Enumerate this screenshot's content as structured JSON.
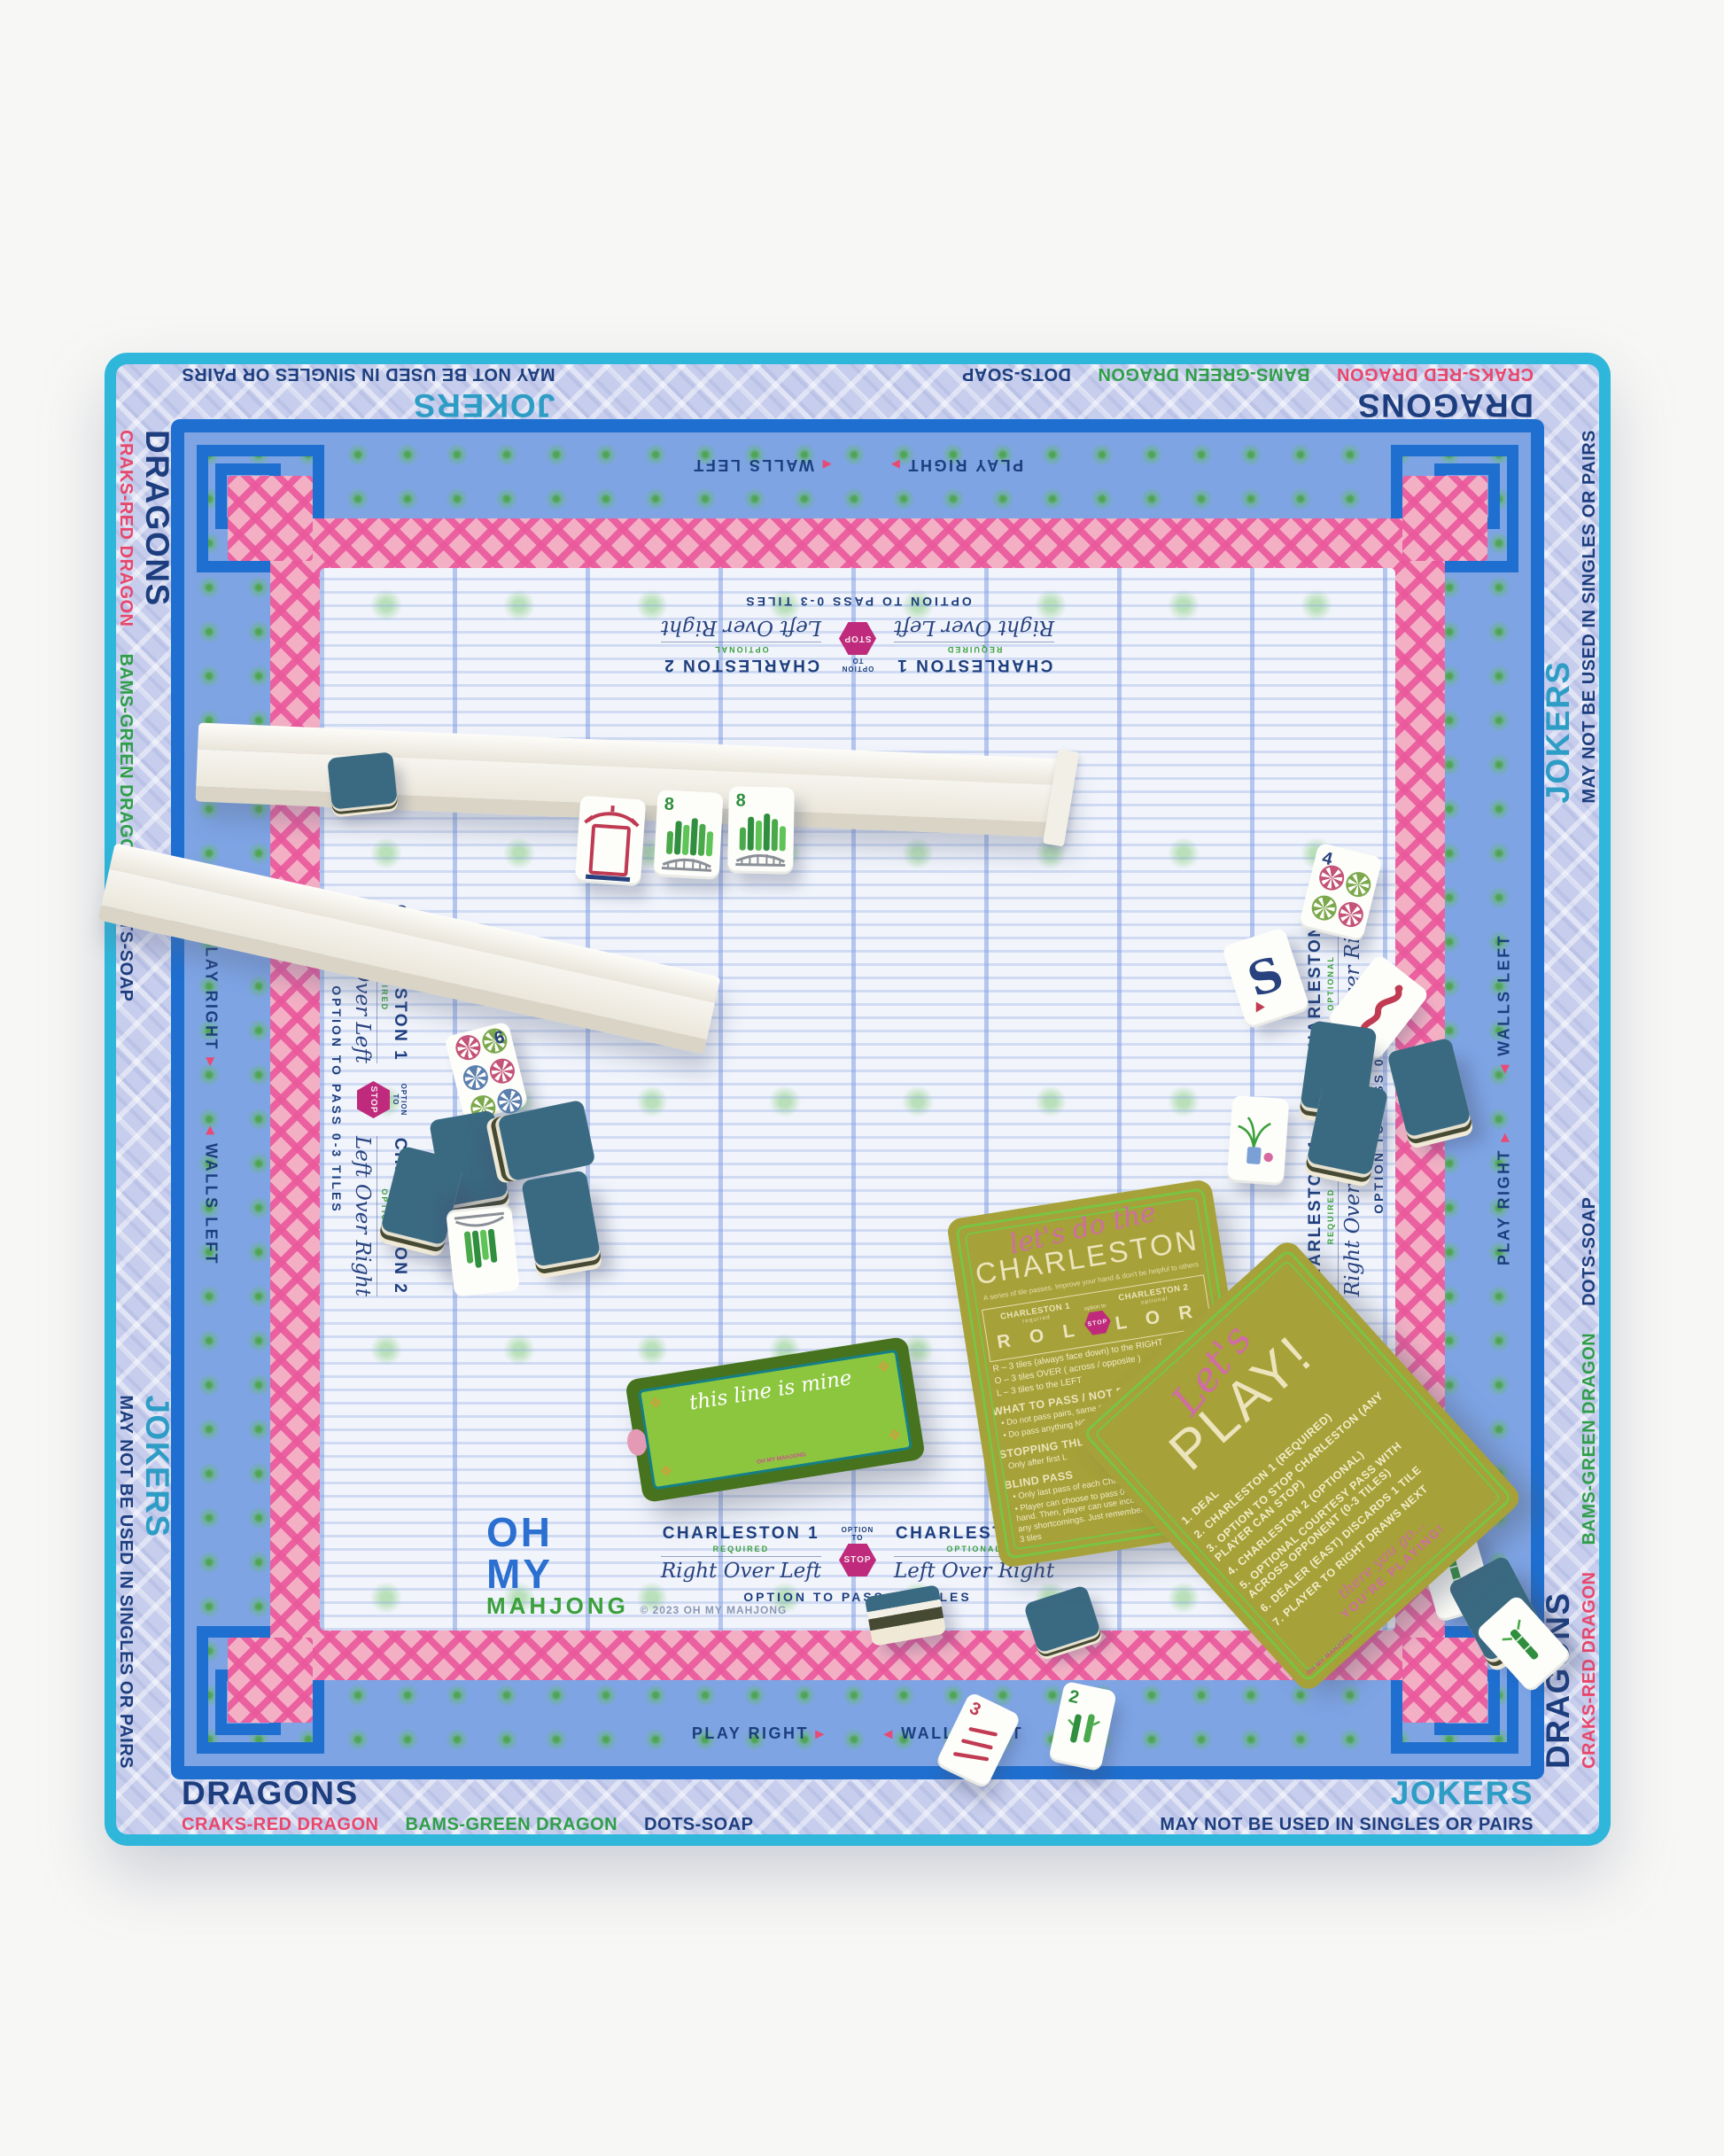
{
  "edge": {
    "dragons": "DRAGONS",
    "jokers": "JOKERS",
    "craks_note": "CRAKS-RED DRAGON",
    "bams_note": "BAMS-GREEN DRAGON",
    "dots_note": "DOTS-SOAP",
    "jokers_note": "MAY NOT BE USED IN SINGLES OR PAIRS"
  },
  "band": {
    "play_right": "PLAY RIGHT",
    "walls_left": "WALLS LEFT",
    "arrow_right": "▸",
    "arrow_left": "◂"
  },
  "charleston_block": {
    "c1_title": "CHARLESTON 1",
    "c1_sub": "REQUIRED",
    "c1_script": "Right Over Left",
    "option_to": "OPTION TO",
    "stop": "STOP",
    "c2_title": "CHARLESTON 2",
    "c2_sub": "OPTIONAL",
    "c2_script": "Left Over Right",
    "pass_note": "OPTION TO PASS 0-3 TILES"
  },
  "logo": {
    "line1": "OH",
    "line2": "MY",
    "line3": "MAHJONG",
    "copyright": "© 2023 OH MY MAHJONG"
  },
  "cards": {
    "charleston": {
      "script": "let's do the",
      "title": "CHARLESTON",
      "subtitle": "A series of tile passes. Improve your hand & don't be helpful to others",
      "box": {
        "c1": "CHARLESTON 1",
        "c1_sub": "required",
        "c1_letters": "R O L",
        "option_to": "option to",
        "stop": "STOP",
        "c2": "CHARLESTON 2",
        "c2_sub": "optional",
        "c2_letters": "L O R"
      },
      "legend_r": "R  –  3 tiles (always face down) to the RIGHT",
      "legend_o": "O  –  3 tiles OVER ( across / opposite )",
      "legend_l": "L  –  3 tiles to the LEFT",
      "s1_title": "WHAT TO PASS / NOT PASS",
      "s1_b1": "•  Do not pass pairs, same #, flowers or dragons",
      "s1_b2": "•  Do pass anything NOT in your longest & strongest suit",
      "s2_title": "STOPPING THE CHARLESTON",
      "s2_b1": "Only after first L",
      "s3_title": "BLIND PASS",
      "s3_b1": "•  Only last pass of each Charleston (first L)",
      "s3_b2": "•  Player can choose to pass 0-3 unwanted tiles from their hand. Then, player can use incoming tiles to make up for any shortcomings. Just remember you must ultimately pass 3 tiles"
    },
    "play": {
      "script": "Let's",
      "title": "PLAY!",
      "steps": [
        "1. DEAL",
        "2. CHARLESTON 1 (REQUIRED)",
        "3. OPTION TO STOP CHARLESTON (ANY PLAYER CAN STOP)",
        "4. CHARLESTON 2 (OPTIONAL)",
        "5. OPTIONAL COURTESY PASS WITH ACROSS OPPONENT (0-3 TILES)",
        "6. DEALER (EAST) DISCARDS 1 TILE",
        "7. PLAYER TO RIGHT DRAWS NEXT"
      ],
      "footer_script": "there you go...",
      "footer": "YOU'RE PLAYING!"
    },
    "line": {
      "script": "this line is mine"
    },
    "mini_logo": "OH MY MAHJONG"
  },
  "tiles": {
    "six_dot": "6",
    "eight_bam": "8",
    "four_dot": "4",
    "two_bam": "2",
    "three_crak": "3",
    "south": "S"
  },
  "colors": {
    "binding_teal": "#2fb6db",
    "border_lavender": "#c7cdec",
    "band_periwinkle": "#7ea4e4",
    "bamboo_blue": "#1e6fd0",
    "lattice_pink": "#ea589c",
    "field_blue": "#f1f4fb",
    "navy": "#1d3e7e",
    "jokers_teal": "#2e9dc6",
    "craks_red": "#e8476b",
    "bams_green": "#2f9e49",
    "stop_magenta": "#bf2a7c",
    "card_olive": "#a6a138",
    "card_green": "#78c544",
    "tile_back_blue": "#3a6a82"
  }
}
